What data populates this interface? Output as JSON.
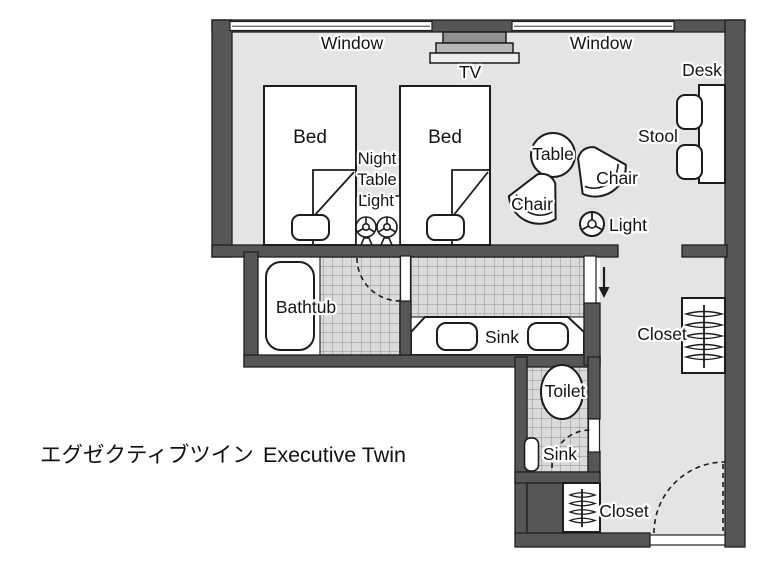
{
  "title": {
    "japanese": "エグゼクティブツイン",
    "english": "Executive Twin"
  },
  "labels": {
    "window_left": "Window",
    "window_right": "Window",
    "tv": "TV",
    "desk": "Desk",
    "stool": "Stool",
    "bed_left": "Bed",
    "bed_right": "Bed",
    "night_table_line1": "Night",
    "night_table_line2": "Table",
    "night_table_line3": "Light",
    "table": "Table",
    "chair_left": "Chair",
    "chair_right": "Chair",
    "floor_light": "Light",
    "bathtub": "Bathtub",
    "vanity_sink": "Sink",
    "toilet": "Toilet",
    "toilet_sink": "Sink",
    "closet_hall": "Closet",
    "closet_entry": "Closet"
  },
  "colors": {
    "wall": "#565656",
    "floor": "#e4e4e4",
    "tile_fill": "#dadada",
    "tile_line": "#8e8e8e",
    "outline": "#1c1c1c",
    "background": "#ffffff"
  }
}
